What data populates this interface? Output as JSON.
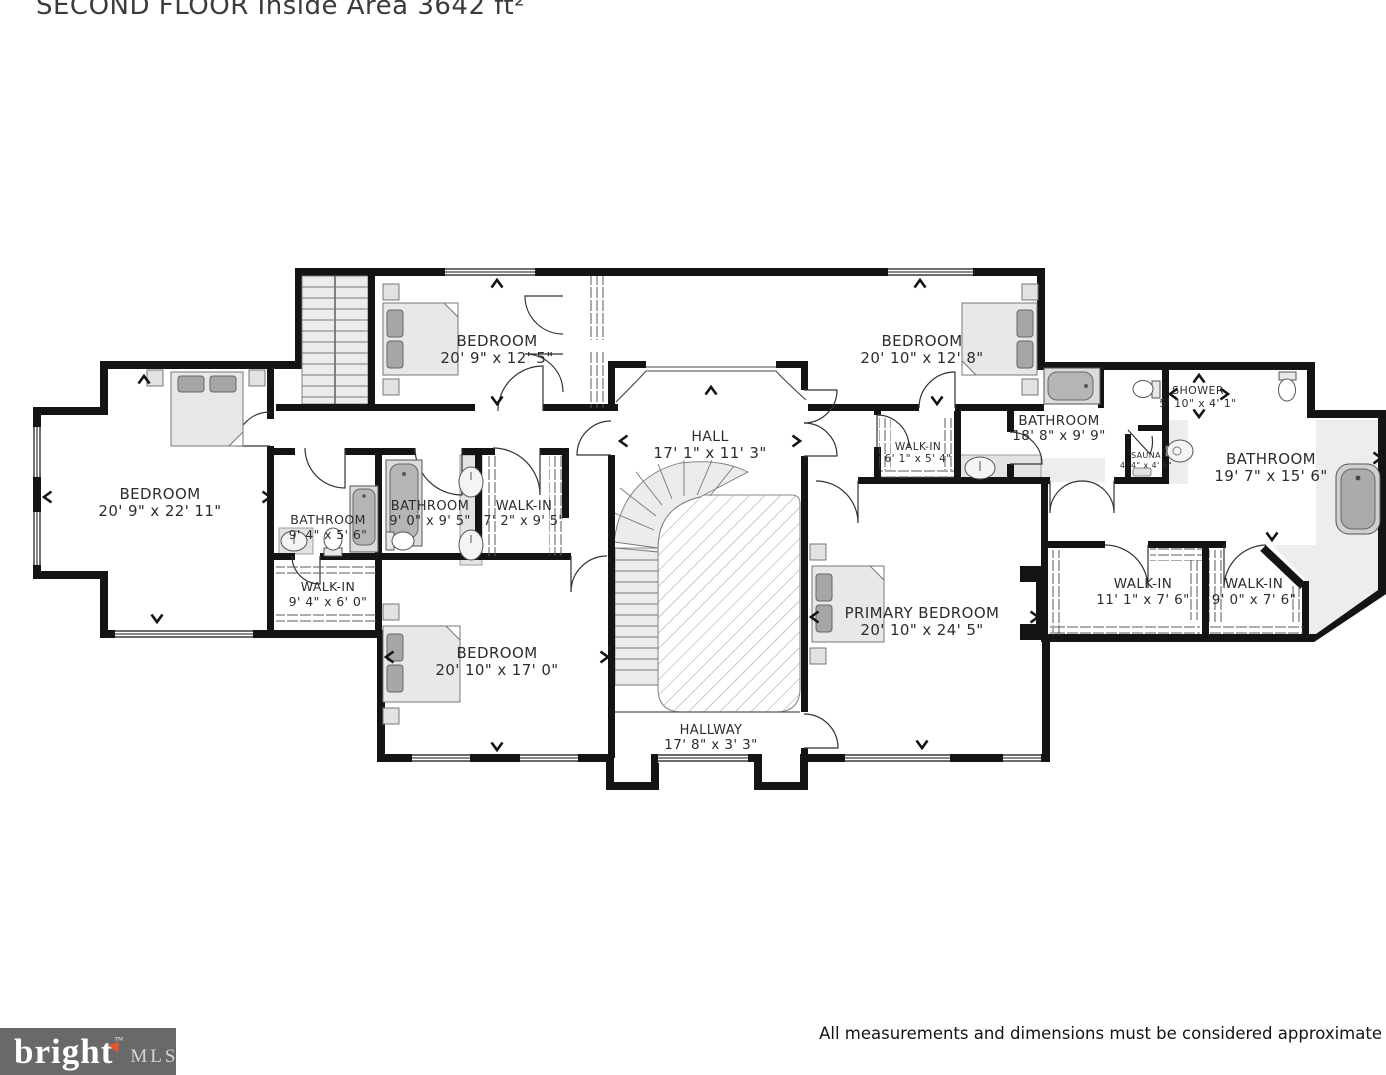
{
  "page": {
    "title": "SECOND FLOOR Inside Area 3642 ft²",
    "footer_disclaimer": "All measurements and dimensions must be considered approximate",
    "logo": {
      "brand": "bright",
      "tm": "™",
      "suffix": "MLS"
    }
  },
  "colors": {
    "wall": "#141414",
    "floor": "#ffffff",
    "tile_floor": "#ededed",
    "furniture_fill": "#e8e8e8",
    "pillow_fill": "#a6a6a6",
    "logo_background": "#696969",
    "logo_accent": "#e8542d",
    "label_text": "#2d2d2d"
  },
  "floorplan": {
    "rooms": [
      {
        "id": "bedroom-top-left",
        "name": "BEDROOM",
        "dims": "20' 9\" x 12' 5\"",
        "x": 497,
        "y": 346,
        "y2": 363,
        "fs": 15,
        "fs2": 15
      },
      {
        "id": "bedroom-top-right",
        "name": "BEDROOM",
        "dims": "20' 10\" x 12' 8\"",
        "x": 922,
        "y": 346,
        "y2": 363,
        "fs": 15,
        "fs2": 15
      },
      {
        "id": "hall",
        "name": "HALL",
        "dims": "17' 1\" x 11' 3\"",
        "x": 710,
        "y": 441,
        "y2": 458,
        "fs": 14,
        "fs2": 15
      },
      {
        "id": "bedroom-left",
        "name": "BEDROOM",
        "dims": "20' 9\" x 22' 11\"",
        "x": 160,
        "y": 499,
        "y2": 516,
        "fs": 15,
        "fs2": 15
      },
      {
        "id": "bathroom-left",
        "name": "BATHROOM",
        "dims": "9' 4\" x 5' 6\"",
        "x": 328,
        "y": 524,
        "y2": 539,
        "fs": 12.5,
        "fs2": 12.5
      },
      {
        "id": "walk-in-left",
        "name": "WALK-IN",
        "dims": "9' 4\" x 6' 0\"",
        "x": 328,
        "y": 591,
        "y2": 606,
        "fs": 12.5,
        "fs2": 12.5
      },
      {
        "id": "bathroom-middle",
        "name": "BATHROOM",
        "dims": "9' 0\" x 9' 5\"",
        "x": 430,
        "y": 510,
        "y2": 525,
        "fs": 13,
        "fs2": 13
      },
      {
        "id": "walk-in-middle",
        "name": "WALK-IN",
        "dims": "7' 2\" x 9' 5\"",
        "x": 524,
        "y": 510,
        "y2": 525,
        "fs": 13,
        "fs2": 13
      },
      {
        "id": "walk-in-small",
        "name": "WALK-IN",
        "dims": "6' 1\" x 5' 4\"",
        "x": 918,
        "y": 450,
        "y2": 462,
        "fs": 10.5,
        "fs2": 10.5
      },
      {
        "id": "bathroom-top-right",
        "name": "BATHROOM",
        "dims": "18' 8\" x 9' 9\"",
        "x": 1059,
        "y": 425,
        "y2": 440,
        "fs": 13.5,
        "fs2": 13.5
      },
      {
        "id": "shower",
        "name": "SHOWER",
        "dims": "5' 10\" x 4' 1\"",
        "x": 1198,
        "y": 394,
        "y2": 407,
        "fs": 11,
        "fs2": 11
      },
      {
        "id": "sauna",
        "name": "SAUNA",
        "dims": "4' 4\" x 4' 6\"",
        "x": 1146,
        "y": 458,
        "y2": 468,
        "fs": 8,
        "fs2": 8
      },
      {
        "id": "bathroom-right",
        "name": "BATHROOM",
        "dims": "19' 7\" x 15' 6\"",
        "x": 1271,
        "y": 464,
        "y2": 481,
        "fs": 15,
        "fs2": 15
      },
      {
        "id": "bedroom-bottom",
        "name": "BEDROOM",
        "dims": "20' 10\" x 17' 0\"",
        "x": 497,
        "y": 658,
        "y2": 675,
        "fs": 15,
        "fs2": 15
      },
      {
        "id": "primary-bedroom",
        "name": "PRIMARY BEDROOM",
        "dims": "20' 10\" x 24' 5\"",
        "x": 922,
        "y": 618,
        "y2": 635,
        "fs": 15,
        "fs2": 15
      },
      {
        "id": "walk-in-11",
        "name": "WALK-IN",
        "dims": "11' 1\" x 7' 6\"",
        "x": 1143,
        "y": 588,
        "y2": 604,
        "fs": 13.5,
        "fs2": 13.5
      },
      {
        "id": "walk-in-9",
        "name": "WALK-IN",
        "dims": "9' 0\" x 7' 6\"",
        "x": 1254,
        "y": 588,
        "y2": 604,
        "fs": 13.5,
        "fs2": 13.5
      },
      {
        "id": "hallway",
        "name": "HALLWAY",
        "dims": "17' 8\" x 3' 3\"",
        "x": 711,
        "y": 734,
        "y2": 749,
        "fs": 13,
        "fs2": 13.5
      }
    ]
  }
}
